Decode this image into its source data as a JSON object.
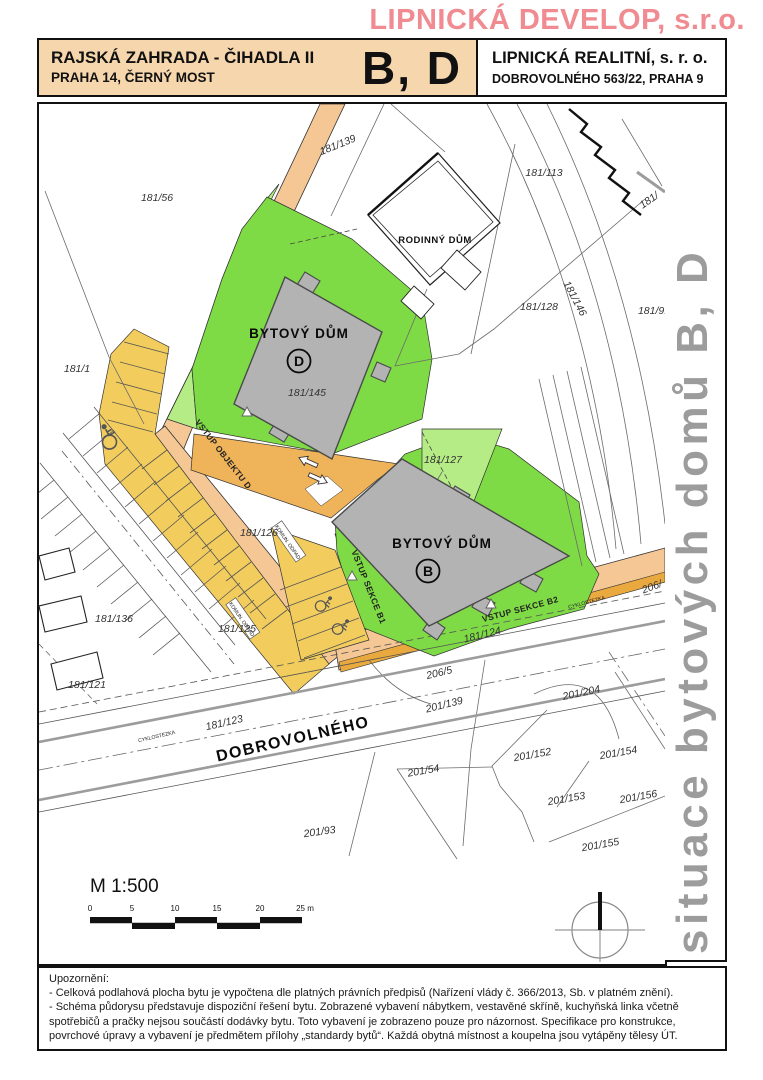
{
  "header": {
    "company": "LIPNICKÁ DEVELOP, s.r.o."
  },
  "title_block": {
    "project_title": "RAJSKÁ ZAHRADA - ČIHADLA II",
    "project_location": "PRAHA 14, ČERNÝ MOST",
    "building_codes": "B, D",
    "realtor_name": "LIPNICKÁ REALITNÍ, s. r. o.",
    "realtor_address": "DOBROVOLNÉHO 563/22, PRAHA 9"
  },
  "sidebar": {
    "title": "situace bytových domů B, D"
  },
  "map": {
    "building_d_label": "BYTOVÝ DŮM",
    "building_d_letter": "D",
    "building_b_label": "BYTOVÝ DŮM",
    "building_b_letter": "B",
    "family_house_label": "RODINNÝ DŮM",
    "street_name": "DOBROVOLNÉHO",
    "bike_path_label": "CYKLOSTEZKA",
    "waste_label": "KOMUN. ODPAD",
    "entrance_object_d": "VSTUP OBJEKTU D",
    "entrance_section_b1": "VSTUP SEKCE B1",
    "entrance_section_b2": "VSTUP SEKCE B2",
    "parcels": {
      "p181_139": "181/139",
      "p181_56": "181/56",
      "p181_113": "181/113",
      "p181_146": "181/146",
      "p181_91": "181/91",
      "p181_edge": "181/",
      "p181_128": "181/128",
      "p181_1": "181/1",
      "p181_145": "181/145",
      "p181_127": "181/127",
      "p181_126": "181/126",
      "p181_125": "181/125",
      "p181_136": "181/136",
      "p181_121": "181/121",
      "p181_123": "181/123",
      "p181_124": "181/124",
      "p206_5": "206/5",
      "p206_edge": "206/",
      "p201_139": "201/139",
      "p201_204": "201/204",
      "p201_152": "201/152",
      "p201_54": "201/54",
      "p201_153": "201/153",
      "p201_154": "201/154",
      "p201_156": "201/156",
      "p201_155": "201/155",
      "p201_93": "201/93"
    }
  },
  "scale": {
    "label": "M 1:500",
    "ticks": [
      "0",
      "5",
      "10",
      "15",
      "20",
      "25 m"
    ]
  },
  "footer": {
    "heading": "Upozornění:",
    "note_1": "- Celková podlahová plocha bytu je vypočtena dle platných právních předpisů (Nařízení vlády č. 366/2013, Sb. v platném znění).",
    "note_2": "- Schéma půdorysu představuje dispoziční řešení bytu. Zobrazené vybavení nábytkem, vestavěné skříně, kuchyňská linka včetně spotřebičů a pračky nejsou součástí dodávky bytu. Toto vybavení je zobrazeno pouze pro názornost. Specifikace pro konstrukce, povrchové úpravy a vybavení je předmětem přílohy „standardy bytů“. Každá obytná místnost a koupelna jsou vytápěny tělesy ÚT."
  },
  "colors": {
    "accent_pink": "#ef8b91",
    "title_block_bg": "#f6d7ad",
    "road_fill": "#f4c795",
    "bike_path_fill": "#e9a93e",
    "parking_fill": "#f2cd5e",
    "green_main": "#7fdb45",
    "green_light": "#b5ec85",
    "building_fill": "#b3b3b3",
    "sidebar_text": "#9c9c9c"
  }
}
